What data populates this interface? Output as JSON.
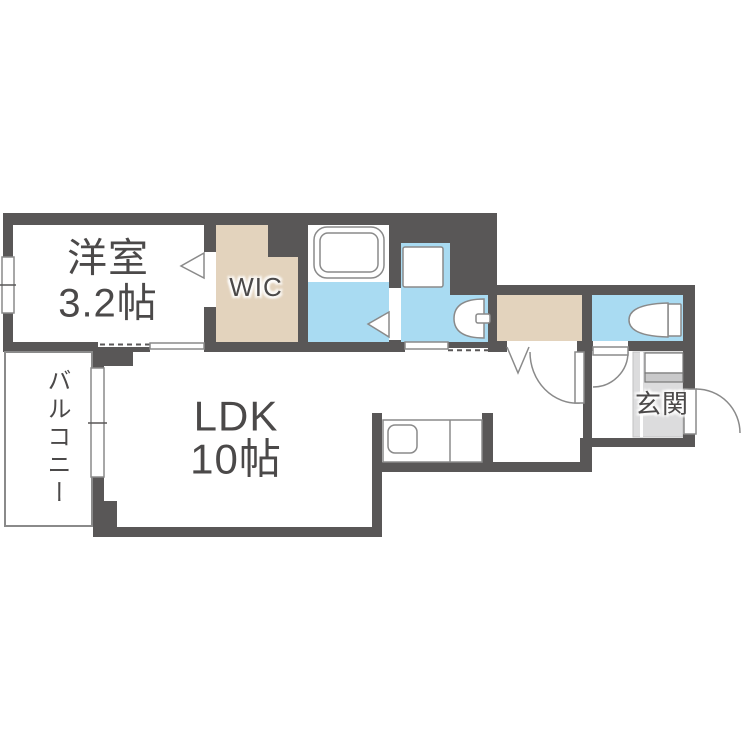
{
  "title": "間取り図 (floor plan)",
  "rooms": {
    "western_room": {
      "name": "洋室",
      "size": "3.2帖"
    },
    "wic": {
      "label": "WIC"
    },
    "ldk": {
      "name": "LDK",
      "size": "10帖"
    },
    "balcony": {
      "label": "バルコニー"
    },
    "entrance": {
      "label": "玄関"
    }
  },
  "fixtures": {
    "bathtub": "bathtub-icon",
    "washing_machine_pan": "washing-machine-pan-icon",
    "washbasin": "washbasin-icon",
    "toilet": "toilet-icon",
    "kitchen_sink": "kitchen-sink-icon",
    "shoe_cabinet": "shoe-cabinet-icon"
  },
  "colors": {
    "wall": "#595757",
    "water": "#a9dbf2",
    "closet": "#e3d3bd",
    "entrance_floor": "#dcdcdd",
    "text": "#4b4949",
    "line": "#8a8a8a"
  }
}
